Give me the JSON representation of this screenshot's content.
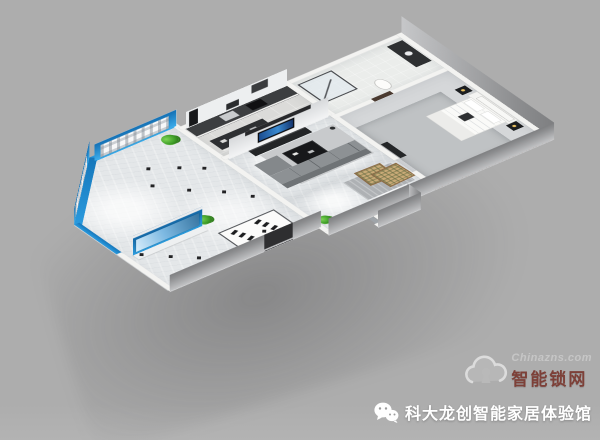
{
  "watermark": {
    "icon": "cloud-keyhole-icon",
    "site_text": "Chinazns.com",
    "brand_text": "智能锁网",
    "site_color": "#c6c6c6",
    "brand_color": "#7d4038"
  },
  "caption": {
    "icon": "wechat-icon",
    "text": "科大龙创智能家居体验馆",
    "color": "#ffffff"
  },
  "scene": {
    "type": "3d-isometric-floorplan-render",
    "description": "smart-home showroom and model apartment",
    "rooms": [
      "showroom",
      "kitchen",
      "living-room",
      "bathroom",
      "bedroom",
      "corridor",
      "balcony"
    ],
    "background_color": "#aeaeae",
    "accent_blue": "#1d8ed6",
    "accent_brown": "#7c3c18",
    "wall_top_color": "#f3f3f1",
    "exterior_wall_color": "#97989a",
    "floor_color": "#e4e7e9",
    "plant_color": "#3f9e28"
  }
}
